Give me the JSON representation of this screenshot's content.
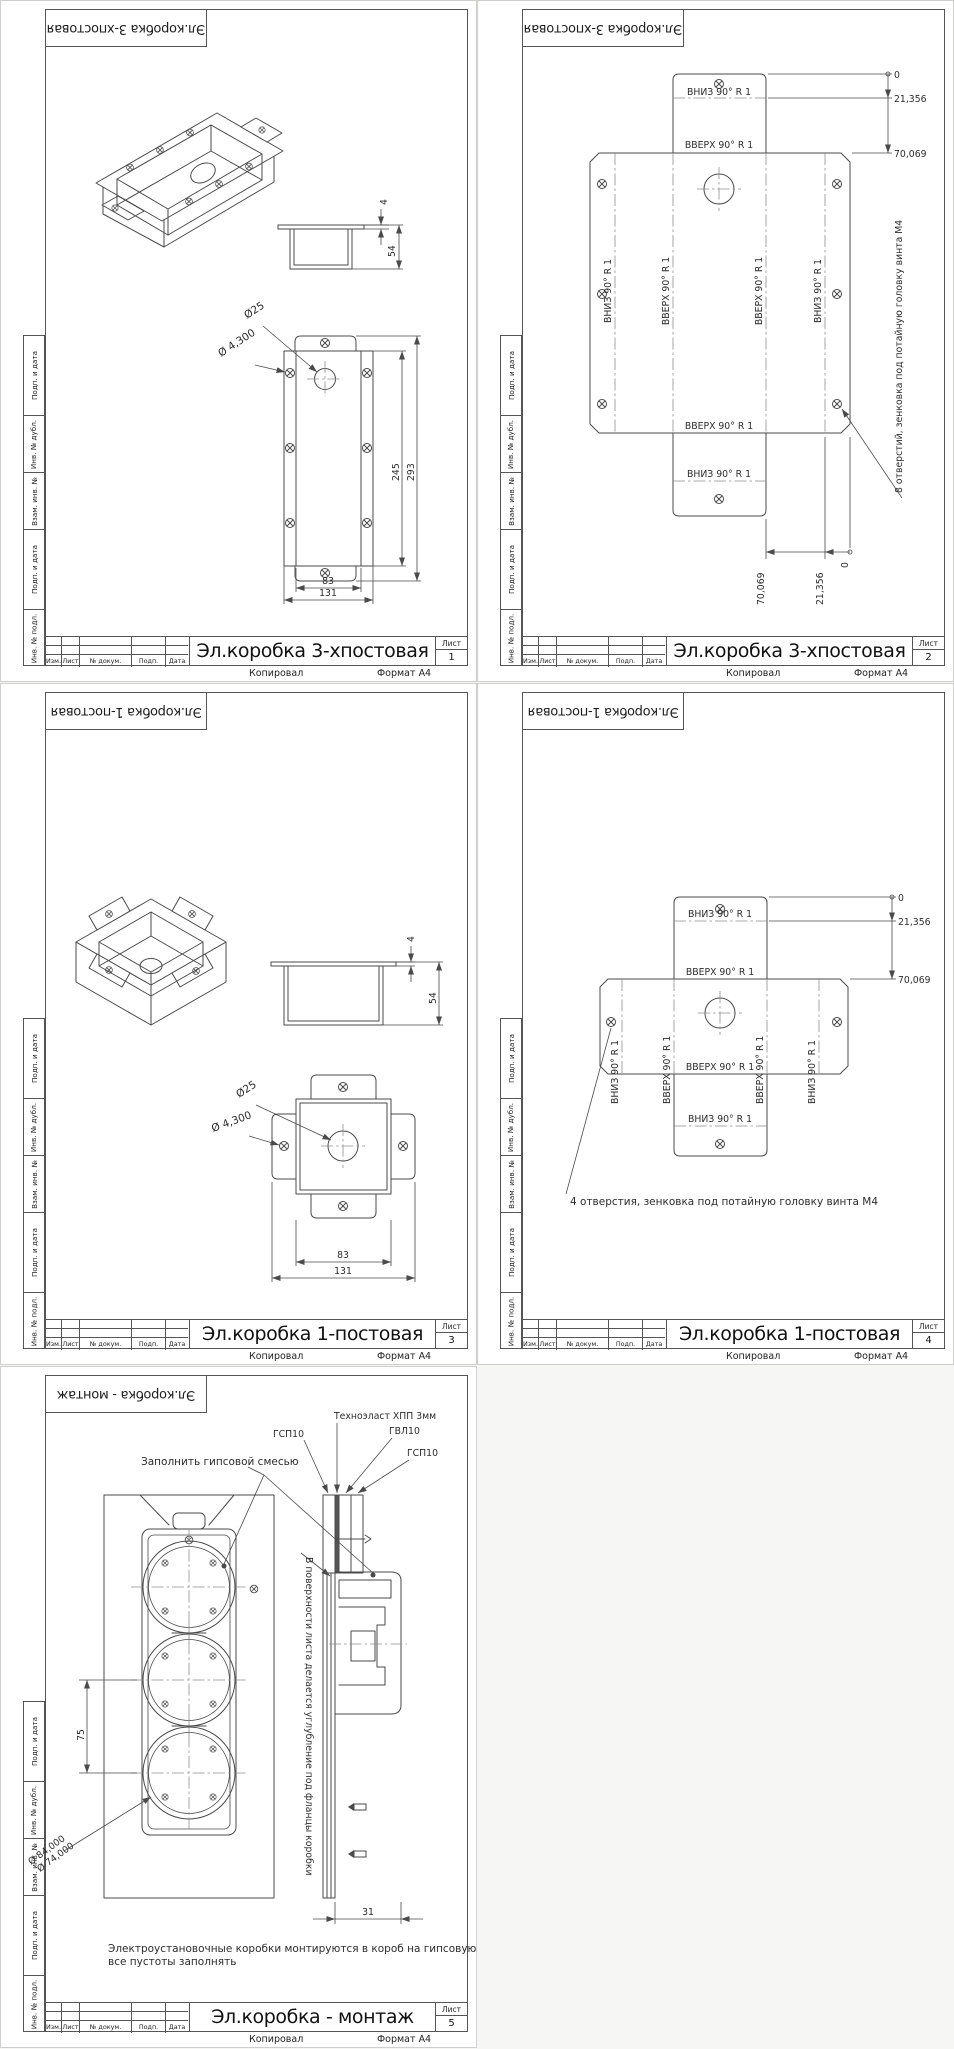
{
  "stamp": {
    "cols": [
      "Изм.",
      "Лист",
      "№ докум.",
      "Подп.",
      "Дата"
    ],
    "sheet_label": "Лист",
    "copied": "Копировал",
    "format": "Формат А4",
    "side": [
      "Подп. и дата",
      "Инв. № дубл.",
      "Взам. инв. №",
      "Подп. и дата",
      "Инв. № подл."
    ]
  },
  "sheets": [
    {
      "title": "Эл.коробка 3-хпостовая",
      "number": "1"
    },
    {
      "title": "Эл.коробка 3-хпостовая",
      "number": "2"
    },
    {
      "title": "Эл.коробка 1-постовая",
      "number": "3"
    },
    {
      "title": "Эл.коробка 1-постовая",
      "number": "4"
    },
    {
      "title": "Эл.коробка - монтаж",
      "number": "5"
    }
  ],
  "s1": {
    "thickness": "4",
    "depth": "54",
    "hole": "Ø25",
    "screw_hole": "Ø 4,300",
    "inner_h": "245",
    "outer_h": "293",
    "inner_w": "83",
    "outer_w": "131"
  },
  "s2": {
    "bend_down": "ВНИЗ 90° R 1",
    "bend_up": "ВВЕРХ 90° R 1",
    "ord0": "0",
    "ord1": "21,356",
    "ord2": "70,069",
    "note": "8 отверстий, зенковка под потайную головку винта М4"
  },
  "s3": {
    "thickness": "4",
    "depth": "54",
    "hole": "Ø25",
    "screw_hole": "Ø 4,300",
    "inner_w": "83",
    "outer_w": "131"
  },
  "s4": {
    "bend_down": "ВНИЗ 90° R 1",
    "bend_up": "ВВЕРХ 90° R 1",
    "ord0": "0",
    "ord1": "21,356",
    "ord2": "70,069",
    "note": "4 отверстия, зенковка под потайную головку винта М4"
  },
  "s5": {
    "layer_tehno": "Техноэласт ХПП 3мм",
    "layer_gsp_left": "ГСП10",
    "layer_gvl": "ГВЛ10",
    "layer_gsp_right": "ГСП10",
    "fill_note": "Заполнить гипсовой смесью",
    "recess_note": "В поверхности листа делается углубление под фланцы коробки",
    "pitch": "75",
    "dia_outer": "Ø 84,000",
    "dia_inner": "Ø 74,000",
    "depth": "31",
    "mount_note_1": "Электроустановочные коробки монтируются в короб на гипсовую смесь,",
    "mount_note_2": "все пустоты заполнять"
  }
}
